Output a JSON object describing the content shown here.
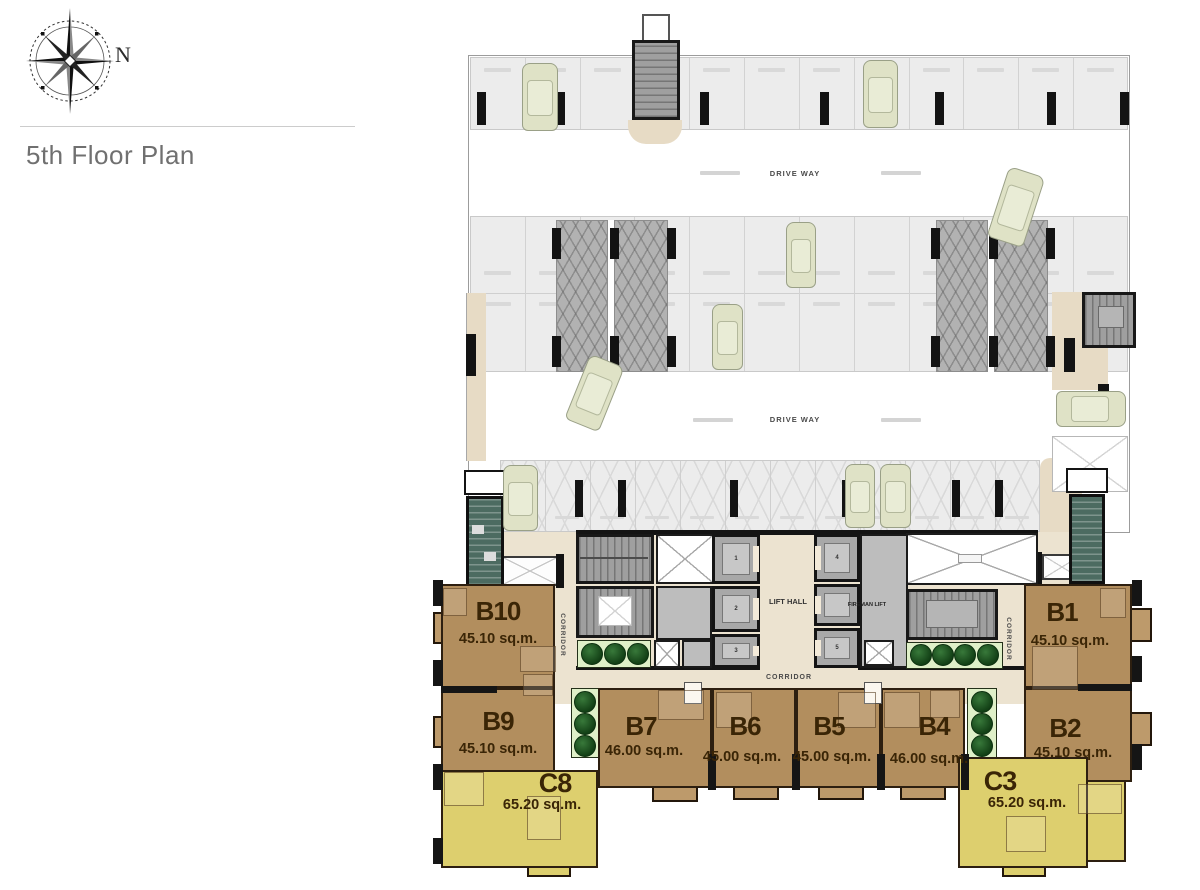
{
  "header": {
    "compass_label": "N",
    "title": "5th Floor Plan"
  },
  "plan": {
    "driveway_labels": [
      "DRIVE WAY",
      "DRIVE WAY"
    ],
    "lift_hall_label": "LIFT HALL",
    "fireman_lift_label": "FIREMAN LIFT",
    "corridor_labels": {
      "horizontal": "CORRIDOR",
      "left_vertical": "CORRIDOR",
      "right_vertical": "CORRIDOR"
    },
    "lift_numbers": [
      "1",
      "2",
      "3",
      "4",
      "5"
    ],
    "units": [
      {
        "id": "B10",
        "area": "45.10 sq.m.",
        "type": "b"
      },
      {
        "id": "B9",
        "area": "45.10 sq.m.",
        "type": "b"
      },
      {
        "id": "C8",
        "area": "65.20 sq.m.",
        "type": "c"
      },
      {
        "id": "B7",
        "area": "46.00 sq.m.",
        "type": "b"
      },
      {
        "id": "B6",
        "area": "45.00 sq.m.",
        "type": "b"
      },
      {
        "id": "B5",
        "area": "45.00 sq.m.",
        "type": "b"
      },
      {
        "id": "B4",
        "area": "46.00 sq.m.",
        "type": "b"
      },
      {
        "id": "B1",
        "area": "45.10 sq.m.",
        "type": "b"
      },
      {
        "id": "B2",
        "area": "45.10 sq.m.",
        "type": "b"
      },
      {
        "id": "C3",
        "area": "65.20 sq.m.",
        "type": "c"
      }
    ],
    "colors": {
      "unit_b": "#b28e5e",
      "unit_c": "#ddcf6e",
      "corridor_beige": "#ece3d0",
      "parking_gray": "#ececec",
      "stair_teal": "#4c6b61",
      "tree_green": "#1c5420",
      "label_brown": "#3a2506"
    }
  }
}
